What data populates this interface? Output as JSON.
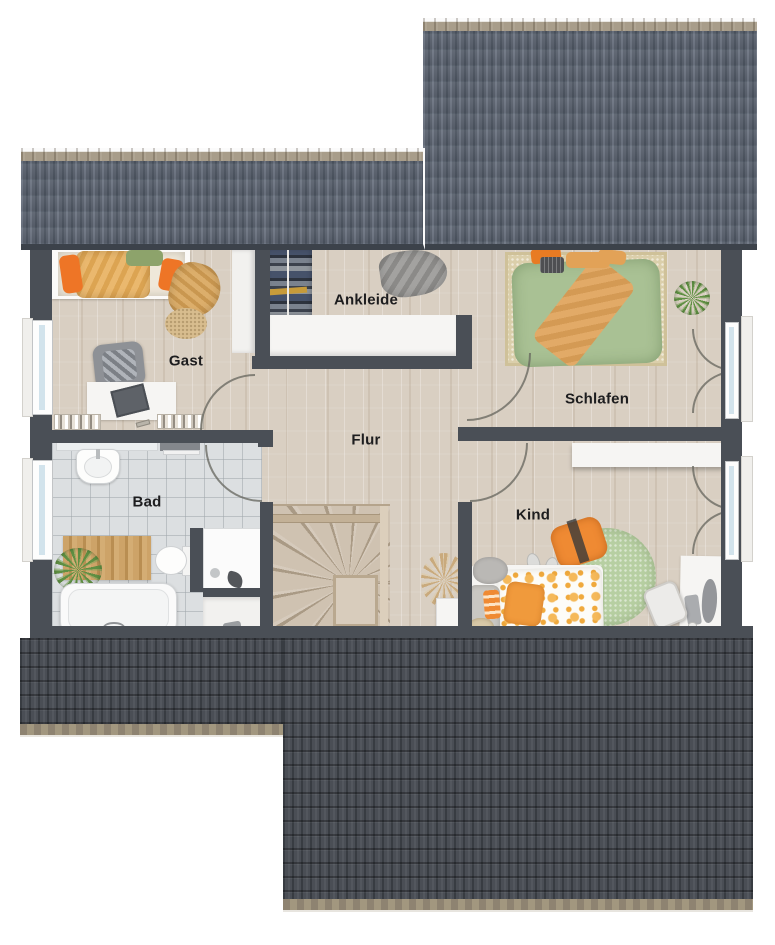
{
  "title": "Obergeschoss Grundriss",
  "rooms": [
    {
      "name": "Gast",
      "furniture": [
        "bed",
        "round-rug",
        "armchair",
        "desk",
        "laptop",
        "bookshelf",
        "tall-wardrobe",
        "window",
        "door"
      ]
    },
    {
      "name": "Ankleide",
      "furniture": [
        "clothes-rail",
        "clothes-pile",
        "sideboard"
      ]
    },
    {
      "name": "Schlafen",
      "furniture": [
        "double-bed",
        "rug",
        "plant",
        "french-window",
        "door"
      ]
    },
    {
      "name": "Flur",
      "furniture": [
        "winder-staircase",
        "dried-plant"
      ]
    },
    {
      "name": "Bad",
      "furniture": [
        "washbasin",
        "toilet",
        "bathtub",
        "shower",
        "bath-mat",
        "plant",
        "radiator",
        "window",
        "door"
      ]
    },
    {
      "name": "Kind",
      "furniture": [
        "child-bed",
        "round-rug",
        "pouf",
        "slippers",
        "desk",
        "desk-chair",
        "wardrobe",
        "cloud-shelf",
        "french-window",
        "door"
      ]
    }
  ],
  "palette": {
    "roof_top": "#5a626e",
    "roof_ridge": "#a89d8a",
    "roof_bottom": "#45494f",
    "roof_eave": "#9a8f7c",
    "wall": "#4a4f56",
    "wood_floor": "#d9cfc2",
    "tile_floor": "#dcdfe1",
    "rug_beige": "#dbcfab",
    "rug_green": "#b7cfa2",
    "duvet_green": "#a9c194",
    "blanket_tan": "#e2aa67",
    "accent_orange": "#ee8a33",
    "label_color": "#1d1d1f"
  }
}
